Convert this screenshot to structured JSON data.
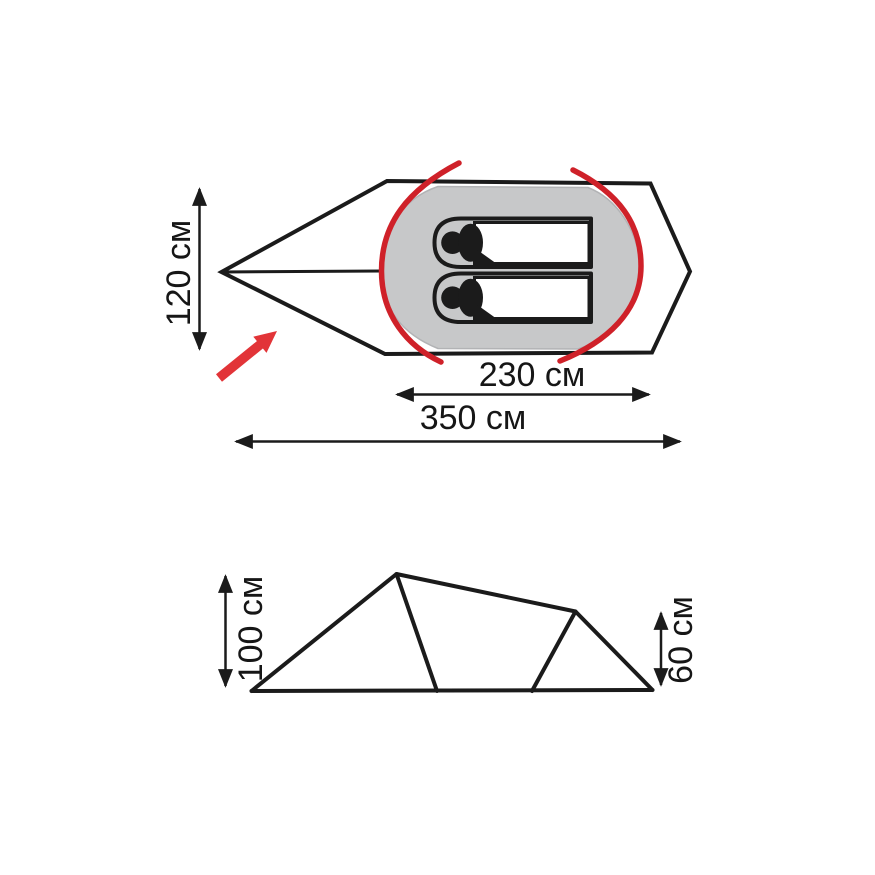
{
  "diagram": {
    "type": "tent-dimension-drawing",
    "top_view": {
      "dimensions": {
        "width_label": "120 см",
        "inner_length_label": "230 см",
        "total_length_label": "350 см"
      },
      "occupant_count": 2
    },
    "side_view": {
      "dimensions": {
        "peak_height_label": "100 см",
        "rear_height_label": "60 см"
      }
    }
  },
  "colors": {
    "line_black": "#1b1b1b",
    "floor_gray": "#c7c8c9",
    "pad_gray": "#c7c8c9",
    "pole_red": "#cf2129",
    "entrance_arrow_red": "#e23438",
    "background_white": "#ffffff"
  }
}
